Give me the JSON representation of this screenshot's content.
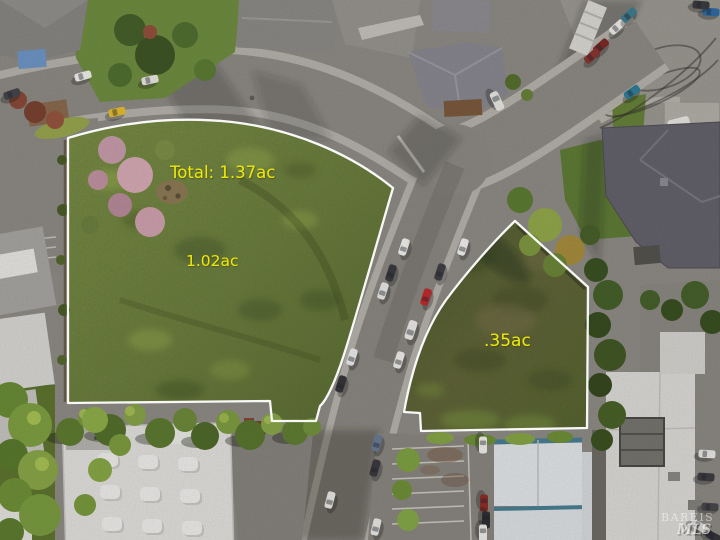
{
  "scene": {
    "kind": "aerial-drone-photo",
    "subject": "Two vacant land parcels outlined in white at a curved residential street intersection",
    "outline_color": "#ffffff",
    "annotation_color": "#ece70d"
  },
  "annotations": {
    "total_acreage": "Total: 1.37ac",
    "parcel_main_acreage": "1.02ac",
    "parcel_secondary_acreage": ".35ac"
  },
  "watermark": {
    "org": "BAREIS",
    "suffix": "MLS"
  }
}
